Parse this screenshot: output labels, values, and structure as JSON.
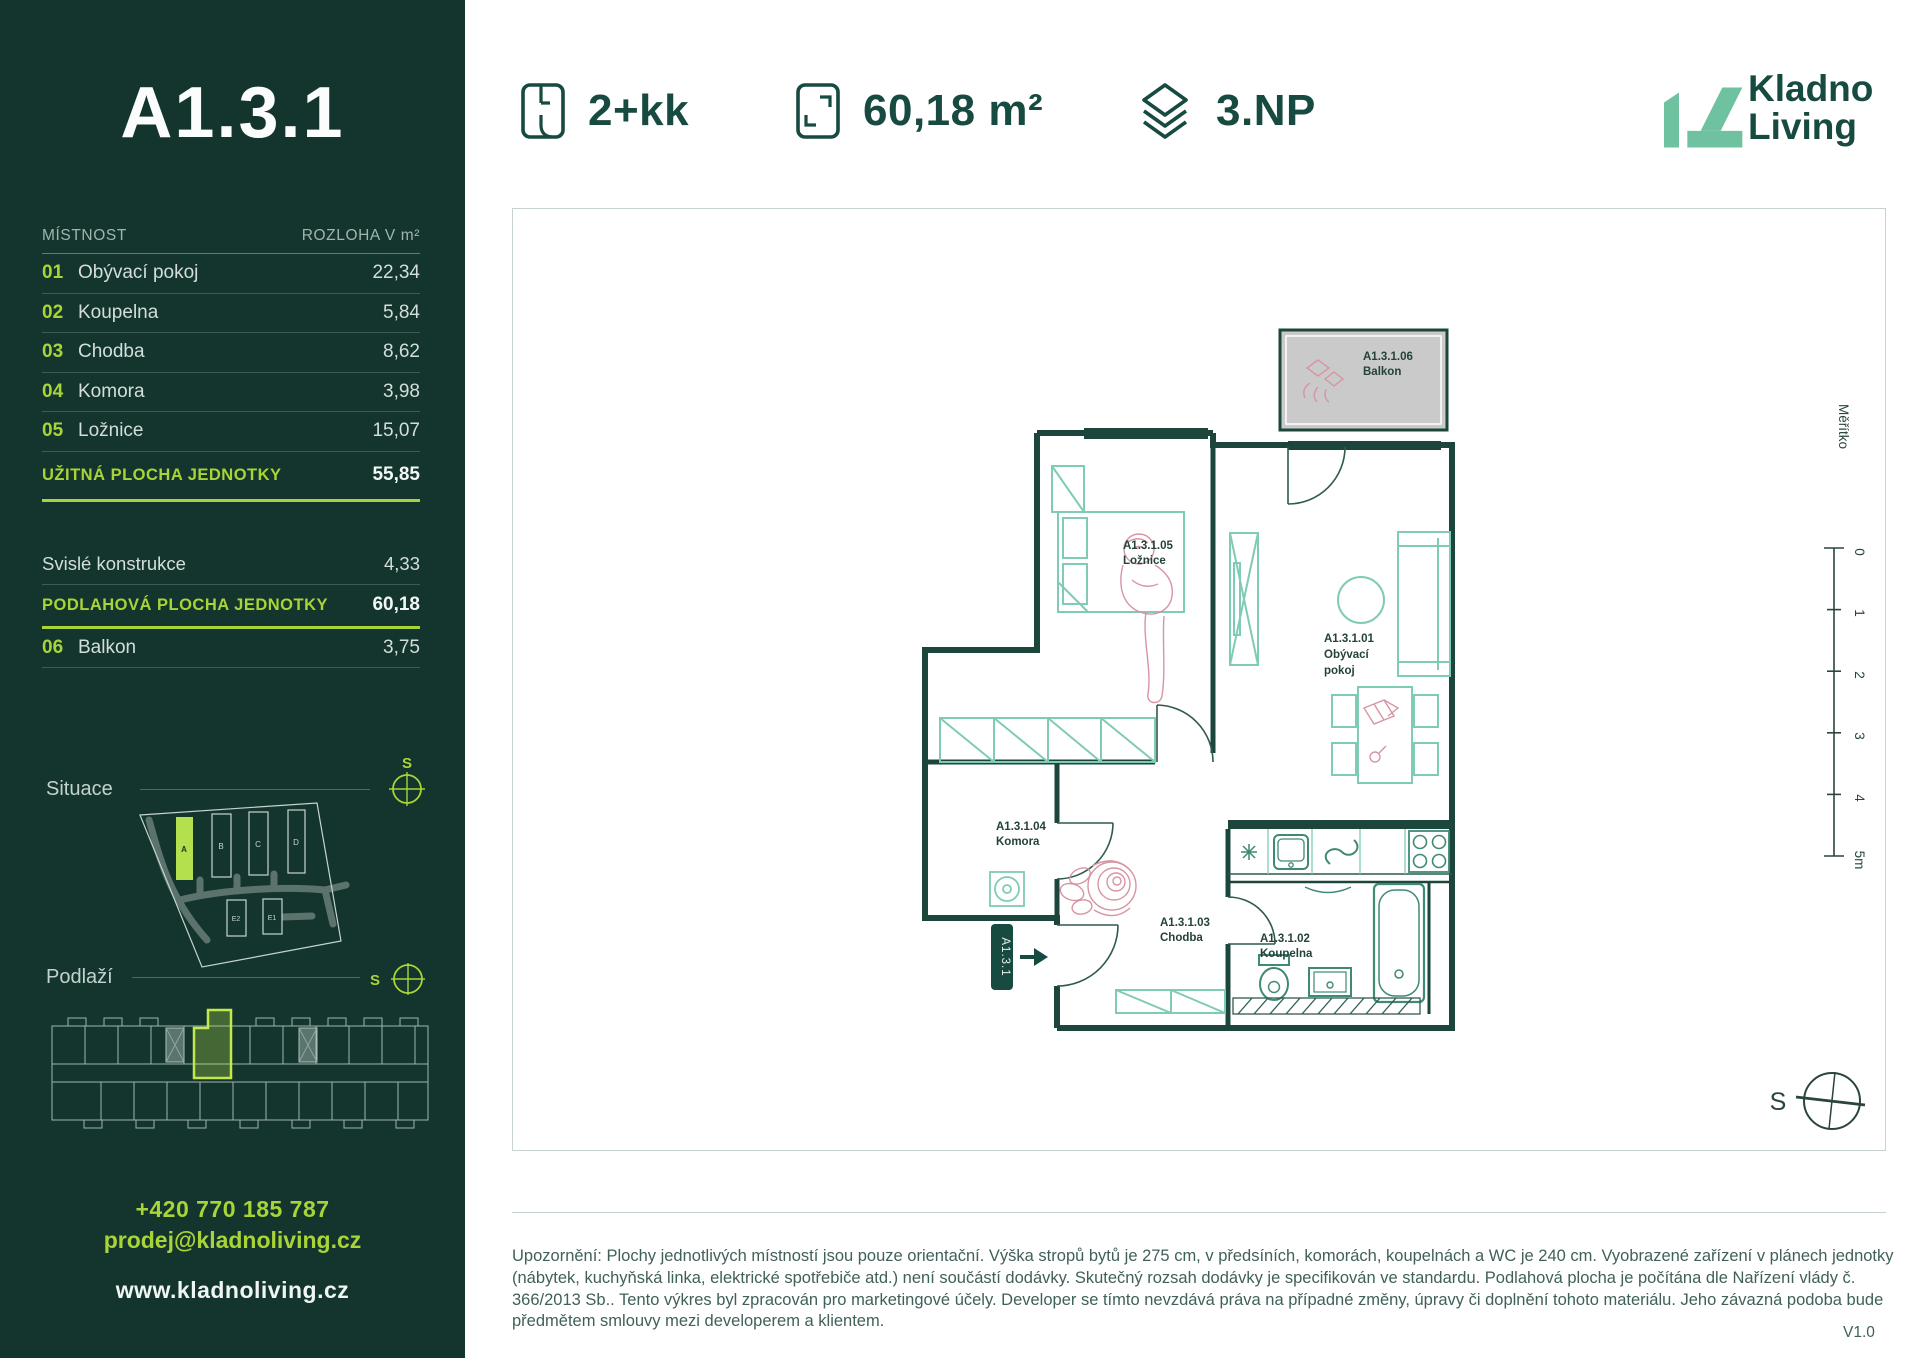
{
  "sidebar": {
    "unit_title": "A1.3.1",
    "table": {
      "col_room": "MÍSTNOST",
      "col_area": "ROZLOHA V m²",
      "rooms": [
        {
          "num": "01",
          "label": "Obývací pokoj",
          "value": "22,34"
        },
        {
          "num": "02",
          "label": "Koupelna",
          "value": "5,84"
        },
        {
          "num": "03",
          "label": "Chodba",
          "value": "8,62"
        },
        {
          "num": "04",
          "label": "Komora",
          "value": "3,98"
        },
        {
          "num": "05",
          "label": "Ložnice",
          "value": "15,07"
        }
      ],
      "usable": {
        "label": "UŽITNÁ PLOCHA JEDNOTKY",
        "value": "55,85"
      },
      "vertical": {
        "label": "Svislé konstrukce",
        "value": "4,33"
      },
      "floor_area": {
        "label": "PODLAHOVÁ PLOCHA JEDNOTKY",
        "value": "60,18"
      },
      "balcony": {
        "num": "06",
        "label": "Balkon",
        "value": "3,75"
      }
    },
    "situace_label": "Situace",
    "podlazi_label": "Podlaží",
    "compass_letter": "S",
    "site_buildings": [
      "A",
      "B",
      "C",
      "D",
      "E2",
      "E1"
    ],
    "phone": "+420 770 185 787",
    "email": "prodej@kladnoliving.cz",
    "web": "www.kladnoliving.cz"
  },
  "header": {
    "layout": "2+kk",
    "area": "60,18 m²",
    "floor": "3.NP",
    "brand_line1": "Kladno",
    "brand_line2": "Living"
  },
  "plan": {
    "labels": {
      "living": {
        "id": "A1.3.1.01",
        "l1": "Obývací",
        "l2": "pokoj"
      },
      "bathroom": {
        "id": "A1.3.1.02",
        "name": "Koupelna"
      },
      "hall": {
        "id": "A1.3.1.03",
        "name": "Chodba"
      },
      "storage": {
        "id": "A1.3.1.04",
        "name": "Komora"
      },
      "bedroom": {
        "id": "A1.3.1.05",
        "name": "Ložnice"
      },
      "balcony": {
        "id": "A1.3.1.06",
        "name": "Balkon"
      }
    },
    "entry_tag": "A1.3.1",
    "scale": {
      "label": "Měřítko",
      "ticks": [
        "0",
        "1",
        "2",
        "3",
        "4",
        "5m"
      ]
    },
    "compass_letter": "S"
  },
  "footer": {
    "disclaimer": "Upozornění: Plochy jednotlivých místností jsou pouze orientační. Výška stropů bytů je 275 cm, v předsíních, komorách, koupelnách a WC je 240 cm. Vyobrazené zařízení v plánech jednotky (nábytek, kuchyňská linka, elektrické spotřebiče atd.) není součástí dodávky. Skutečný rozsah dodávky je specifikován ve standardu. Podlahová plocha je počítána dle Nařízení vlády č. 366/2013 Sb.. Tento výkres byl zpracován pro marketingové účely. Developer se tímto nevzdává práva na případné změny, úpravy či doplnění tohoto materiálu. Jeho závazná podoba bude předmětem smlouvy mezi developerem a klientem.",
    "version": "V1.0"
  },
  "colors": {
    "sidebar_bg": "#14352E",
    "accent_lime": "#A9D437",
    "highlight_lime": "#B5E04D",
    "brand_dark_green": "#174A40",
    "wall_teal": "#1C453C",
    "furniture_teal": "#7FCBB5",
    "sketch_pink": "#D795A3",
    "balcony_gray": "#CACACA",
    "logo_mint": "#6FC2A0"
  }
}
